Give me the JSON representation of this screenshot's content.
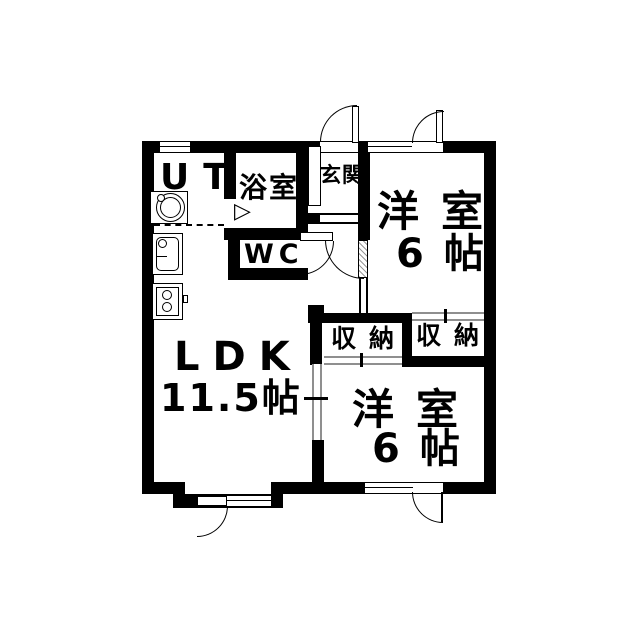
{
  "floorplan": {
    "rooms": {
      "ut": {
        "label": "UT"
      },
      "bath": {
        "label": "浴室"
      },
      "entrance": {
        "label": "玄関"
      },
      "wc": {
        "label": "WC"
      },
      "bedroom_top": {
        "label": "洋室",
        "size": "6帖"
      },
      "closet_left": {
        "label": "収納"
      },
      "closet_right": {
        "label": "収納"
      },
      "ldk": {
        "label": "LDK",
        "size": "11.5帖"
      },
      "bedroom_bottom": {
        "label": "洋室",
        "size": "6帖"
      }
    },
    "symbols": {
      "bath_folding_door": "▷"
    },
    "colors": {
      "wall": "#000000",
      "background": "#ffffff",
      "sliding_door": "#8f8f8f"
    }
  }
}
